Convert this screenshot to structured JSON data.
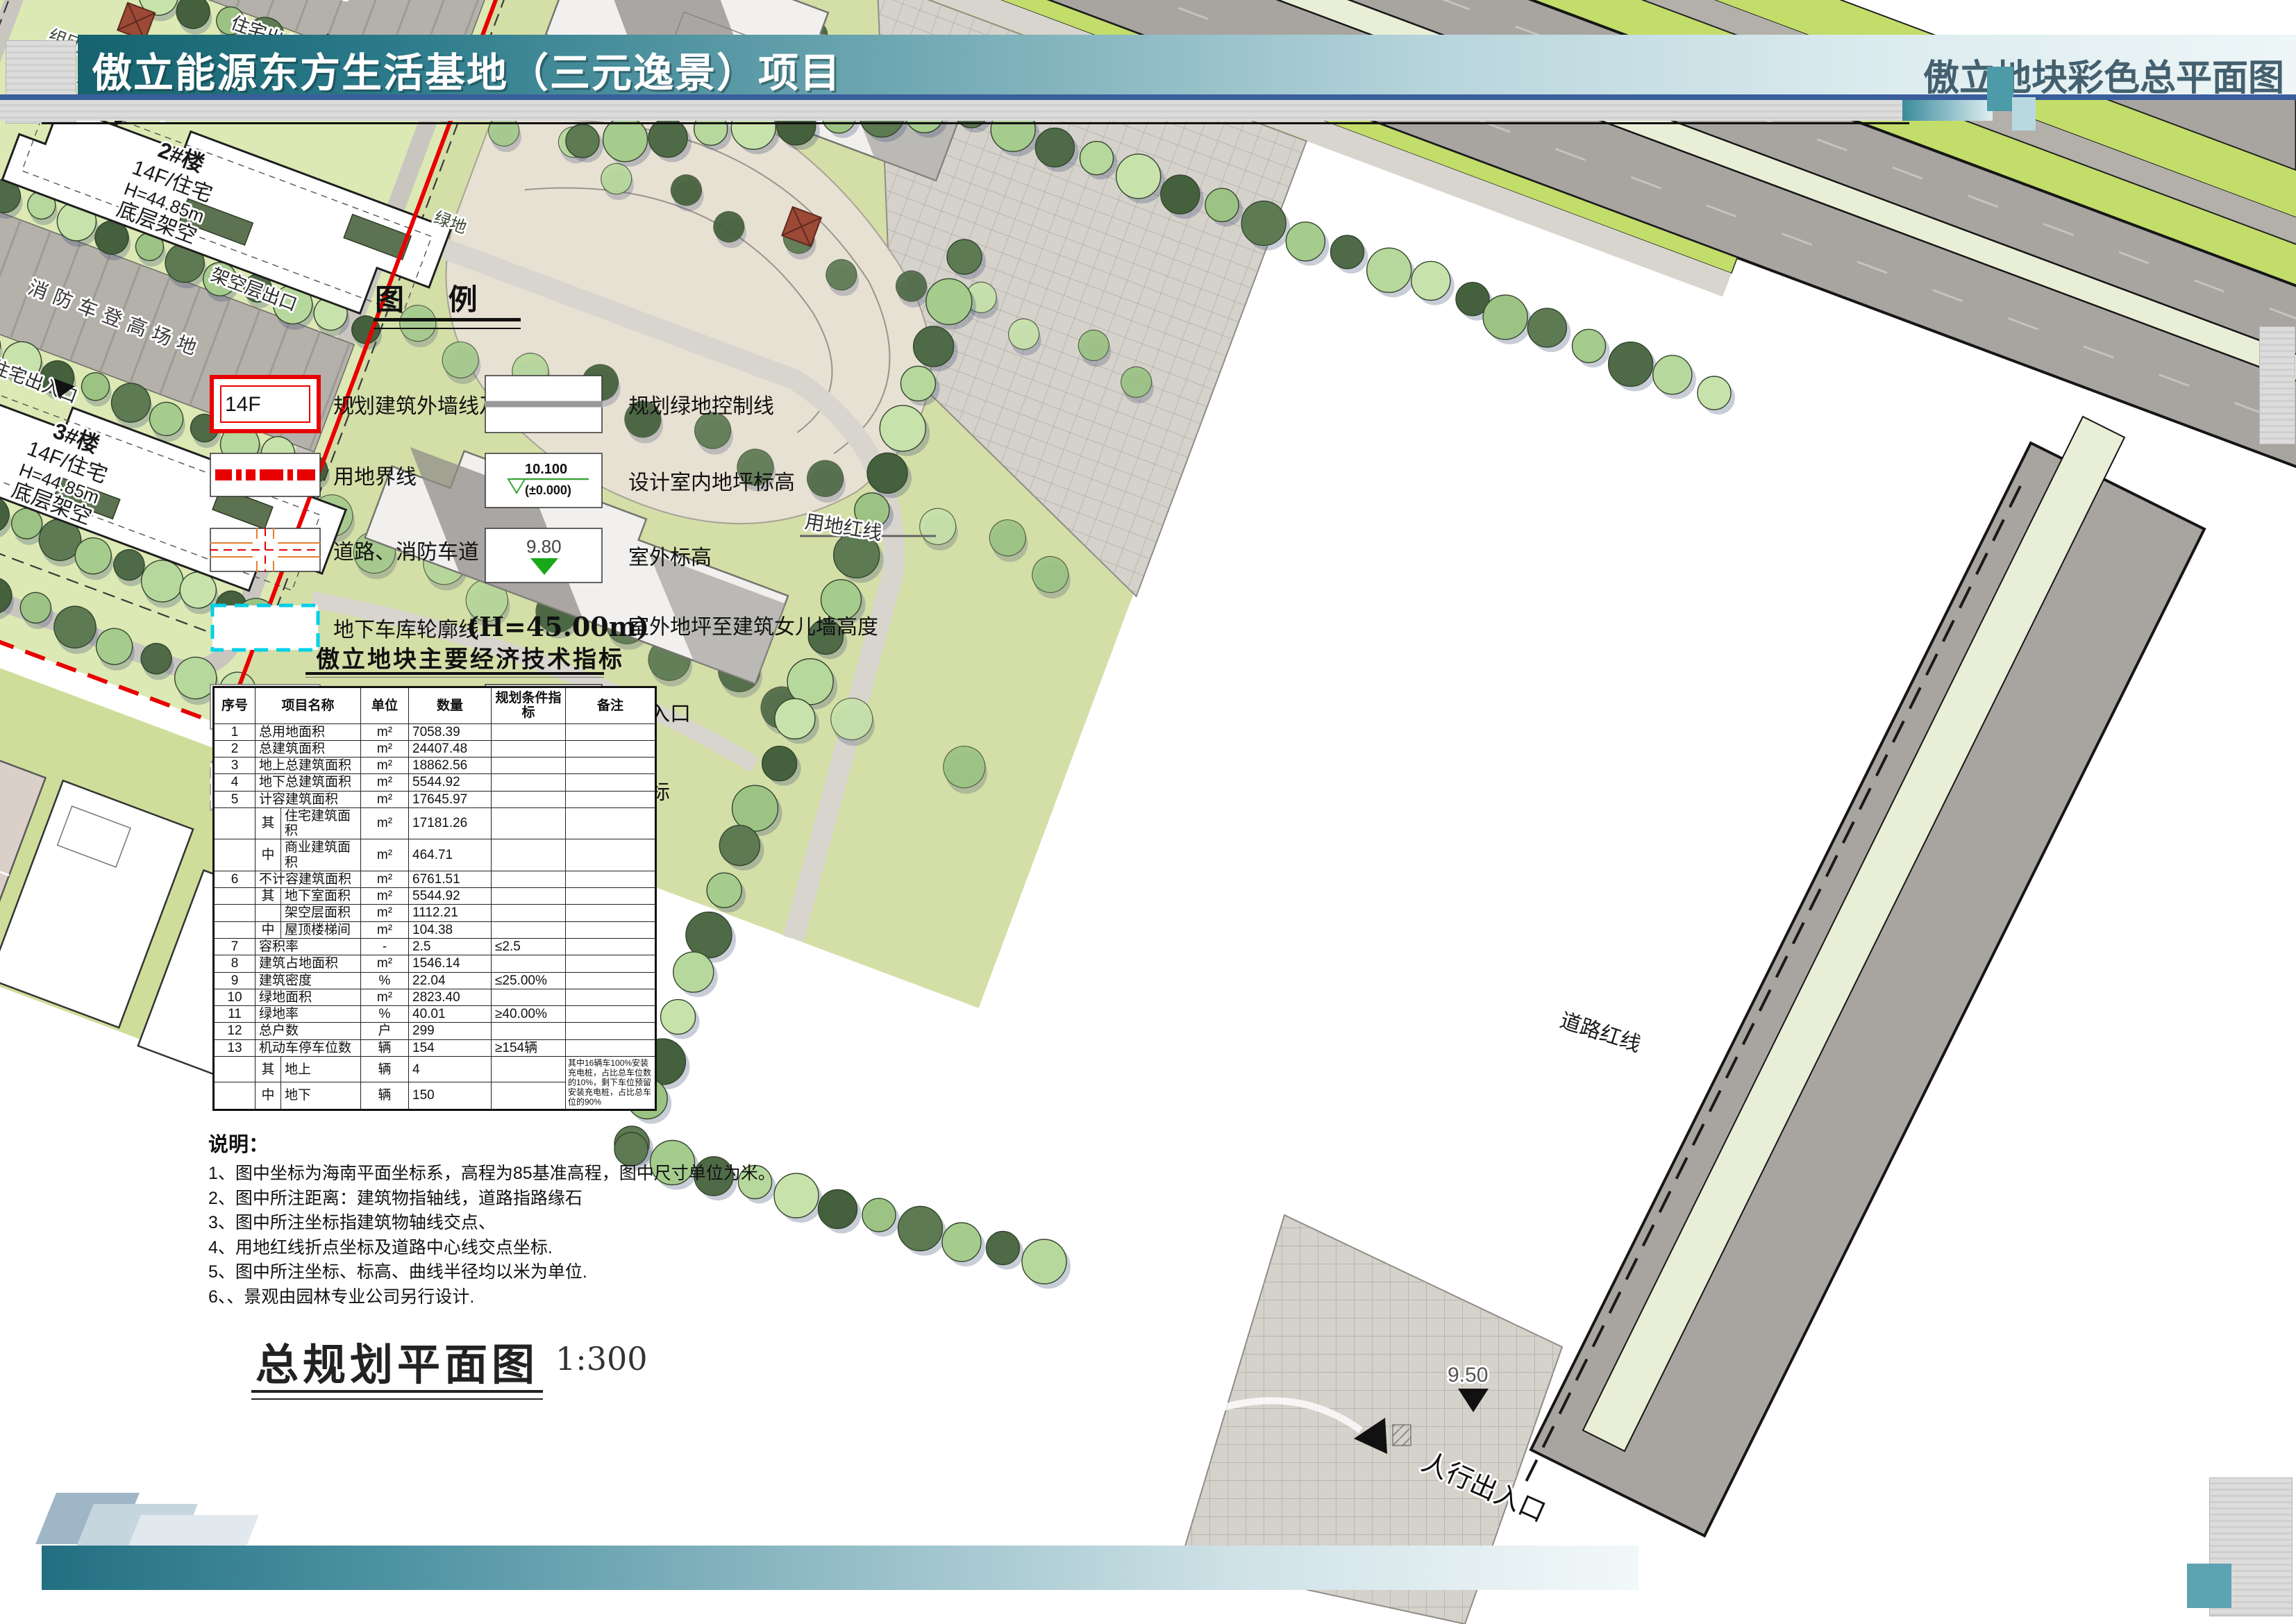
{
  "header": {
    "title": "傲立能源东方生活基地（三元逸景）项目",
    "subtitle": "傲立地块彩色总平面图"
  },
  "legend": {
    "title": "图  例",
    "items_left": [
      {
        "label": "规划建筑外墙线及层数",
        "symbol": "red-building-outline",
        "symbol_text": "14F"
      },
      {
        "label": "用地界线",
        "symbol": "red-dashed-line"
      },
      {
        "label": "道路、消防车道",
        "symbol": "road-cross"
      },
      {
        "label": "地下车库轮廓线",
        "symbol": "cyan-dashed-rect"
      },
      {
        "label": "地下车库出入口",
        "symbol": "green-chevron-ramp"
      },
      {
        "label": "消防登高操作场地",
        "symbol": "gray-cross-hatch"
      }
    ],
    "items_right": [
      {
        "label": "规划绿地控制线",
        "symbol": "gray-line"
      },
      {
        "label": "设计室内地坪标高",
        "symbol": "level-marker",
        "symbol_text": "10.100",
        "symbol_subtext": "(±0.000)"
      },
      {
        "label": "室外标高",
        "symbol": "green-triangle",
        "symbol_text": "9.80"
      },
      {
        "label": "室外地坪至建筑女儿墙高度",
        "symbol": "text-only",
        "symbol_text": "(H=45.00m)"
      },
      {
        "label": "出入口",
        "symbol": "red-entry-arrow"
      },
      {
        "label": "坐标",
        "symbol": "coordinate-box",
        "symbol_text": "X=112349.411",
        "symbol_subtext": "Y=20119.676"
      }
    ]
  },
  "table": {
    "title": "傲立地块主要经济技术指标",
    "headers": [
      "序号",
      "项目名称",
      "单位",
      "数量",
      "规划条件指标",
      "备注"
    ],
    "rows": [
      {
        "no": "1",
        "name": "总用地面积",
        "unit": "m²",
        "qty": "7058.39",
        "cond": "",
        "remark": ""
      },
      {
        "no": "2",
        "name": "总建筑面积",
        "unit": "m²",
        "qty": "24407.48",
        "cond": "",
        "remark": ""
      },
      {
        "no": "3",
        "name": "地上总建筑面积",
        "unit": "m²",
        "qty": "18862.56",
        "cond": "",
        "remark": ""
      },
      {
        "no": "4",
        "name": "地下总建筑面积",
        "unit": "m²",
        "qty": "5544.92",
        "cond": "",
        "remark": ""
      },
      {
        "no": "5",
        "name": "计容建筑面积",
        "unit": "m²",
        "qty": "17645.97",
        "cond": "",
        "remark": ""
      },
      {
        "no": "",
        "sub": true,
        "prefix": "其",
        "name": "住宅建筑面积",
        "unit": "m²",
        "qty": "17181.26",
        "cond": "",
        "remark": ""
      },
      {
        "no": "",
        "sub": true,
        "prefix": "中",
        "name": "商业建筑面积",
        "unit": "m²",
        "qty": "464.71",
        "cond": "",
        "remark": ""
      },
      {
        "no": "6",
        "name": "不计容建筑面积",
        "unit": "m²",
        "qty": "6761.51",
        "cond": "",
        "remark": ""
      },
      {
        "no": "",
        "sub": true,
        "prefix": "其",
        "name": "地下室面积",
        "unit": "m²",
        "qty": "5544.92",
        "cond": "",
        "remark": ""
      },
      {
        "no": "",
        "sub": true,
        "prefix": "",
        "name": "架空层面积",
        "unit": "m²",
        "qty": "1112.21",
        "cond": "",
        "remark": ""
      },
      {
        "no": "",
        "sub": true,
        "prefix": "中",
        "name": "屋顶楼梯间",
        "unit": "m²",
        "qty": "104.38",
        "cond": "",
        "remark": ""
      },
      {
        "no": "7",
        "name": "容积率",
        "unit": "-",
        "qty": "2.5",
        "cond": "≤2.5",
        "remark": ""
      },
      {
        "no": "8",
        "name": "建筑占地面积",
        "unit": "m²",
        "qty": "1546.14",
        "cond": "",
        "remark": ""
      },
      {
        "no": "9",
        "name": "建筑密度",
        "unit": "%",
        "qty": "22.04",
        "cond": "≤25.00%",
        "remark": ""
      },
      {
        "no": "10",
        "name": "绿地面积",
        "unit": "m²",
        "qty": "2823.40",
        "cond": "",
        "remark": ""
      },
      {
        "no": "11",
        "name": "绿地率",
        "unit": "%",
        "qty": "40.01",
        "cond": "≥40.00%",
        "remark": ""
      },
      {
        "no": "12",
        "name": "总户数",
        "unit": "户",
        "qty": "299",
        "cond": "",
        "remark": ""
      },
      {
        "no": "13",
        "name": "机动车停车位数",
        "unit": "辆",
        "qty": "154",
        "cond": "≥154辆",
        "remark": ""
      },
      {
        "no": "",
        "sub": true,
        "prefix": "其",
        "name": "地上",
        "unit": "辆",
        "qty": "4",
        "cond": "",
        "remark": "其中16辆车100%安装充电桩，占比总车位数的10%，剩下车位预留安装充电桩，占比总车位的90%",
        "remark_rowspan": 2
      },
      {
        "no": "",
        "sub": true,
        "prefix": "中",
        "name": "地下",
        "unit": "辆",
        "qty": "150",
        "cond": "",
        "no_remark_cell": true
      }
    ]
  },
  "notes": {
    "title": "说明：",
    "items": [
      "1、图中坐标为海南平面坐标系，高程为85基准高程，图中尺寸单位为米。",
      "2、图中所注距离：建筑物指轴线，道路指路缘石",
      "3、图中所注坐标指建筑物轴线交点、",
      "4、用地红线折点坐标及道路中心线交点坐标.",
      "5、图中所注坐标、标高、曲线半径均以米为单位.",
      "6、、景观由园林专业公司另行设计."
    ]
  },
  "plan_title": {
    "text": "总规划平面图",
    "scale": "1:300"
  },
  "site": {
    "road_name": "东 府 南 路",
    "top_entrance": "消防出入口 车行出入口",
    "fire_lane": "消防车登高场地",
    "residential_entrance": "住宅出入口",
    "cluster_green": "组团绿地",
    "stilt_exit": "架空层出口",
    "barrier_free_ramp": "无障碍坡道",
    "site_boundary": "用地红线",
    "road_boundary": "道路红线",
    "gate": "大门",
    "pedestrian_entrance": "人行出入口",
    "green_space": "绿地",
    "elevation": "9.50",
    "buildings": [
      {
        "name": "1#楼",
        "type": "14F/住宅",
        "height": "H=44.85m",
        "note": "底层局部架空"
      },
      {
        "name": "2#楼",
        "type": "14F/住宅",
        "height": "H=44.85m",
        "note": "底层架空"
      },
      {
        "name": "3#楼",
        "type": "14F/住宅",
        "height": "H=44.85m",
        "note": "底层架空"
      }
    ],
    "colors": {
      "boundary_red": "#e80000",
      "lawn": "#dce9b4",
      "asphalt": "#a8a5a1",
      "verge_green": "#c3dd6a"
    }
  }
}
